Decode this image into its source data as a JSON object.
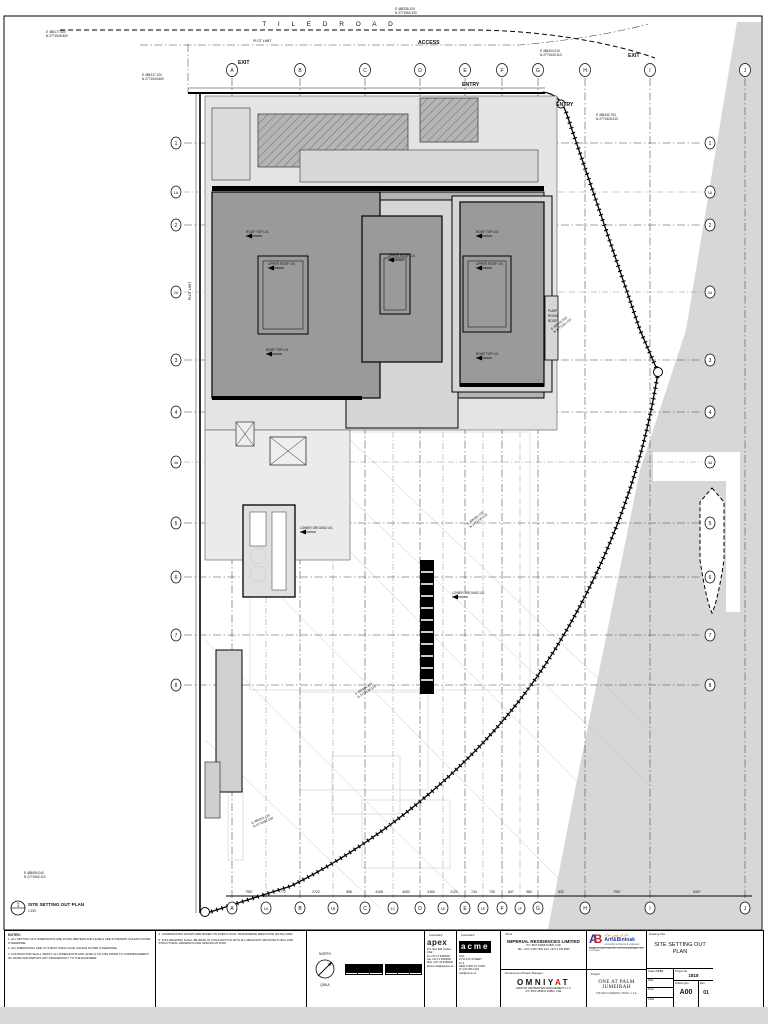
{
  "plan": {
    "road_label": "T I L E D    R O A D",
    "plot_limit": "PLOT LIMIT",
    "plot_limit_side": "PLOT LIMIT",
    "access": "ACCESS",
    "entry1": "ENTRY",
    "entry2": "ENTRY",
    "exit1": "EXIT",
    "exit2": "EXIT",
    "pump_room": [
      "PUMP",
      "ROOM",
      "ROOF"
    ],
    "cols_top": [
      "A",
      "B",
      "C",
      "D",
      "E",
      "F",
      "G",
      "H",
      "I",
      "J"
    ],
    "cols_bottom": [
      "A",
      "1A",
      "B",
      "1B",
      "C",
      "1C",
      "D",
      "1D",
      "E",
      "1E",
      "F",
      "1F",
      "G",
      "H",
      "I",
      "J"
    ],
    "rows": [
      "1",
      "1A",
      "2",
      "2A",
      "3",
      "4",
      "4A",
      "5",
      "6",
      "7",
      "8"
    ],
    "dims": [
      "7967",
      "772",
      "2722",
      "858",
      "4108",
      "4052",
      "3160",
      "2123",
      "744",
      "739",
      "847",
      "980",
      "832",
      "7967",
      "5407"
    ],
    "markers": [
      "ROOF TOP LVL",
      "UPPER ROOF LVL",
      "ROOF TOP LVL",
      "UPPER ROOF LVL",
      "ROOF TOP LVL",
      "UPPER ROOF LVL",
      "ROOF TOP LVL",
      "LOWER GROUND LVL",
      "LOWER GROUND LVL"
    ],
    "coords": [
      {
        "e": "E 485177.520",
        "n": "N 2771549.800"
      },
      {
        "e": "E 485217.120",
        "n": "N 2771543.600"
      },
      {
        "e": "E 485336.120",
        "n": "N 2771560.330"
      },
      {
        "e": "E 485402.010",
        "n": "N 2771549.110"
      },
      {
        "e": "E 485432.700",
        "n": "N 2771528.310"
      },
      {
        "e": "E 485411.010",
        "n": "N 2771352.210"
      },
      {
        "e": "E 485363.120",
        "n": "N 2771230.120"
      },
      {
        "e": "E 485286.220",
        "n": "N 2771138.110"
      },
      {
        "e": "E 485201.120",
        "n": "N 2771082.100"
      },
      {
        "e": "E 485080.040",
        "n": "N 2771062.110"
      }
    ],
    "view": {
      "num": "1",
      "title": "SITE SETTING OUT PLAN",
      "scale": "1:150"
    }
  },
  "titleblock": {
    "notes": {
      "heading": "NOTES:",
      "items": [
        "1.  ALL SETTING OUT DIMENSIONS ARE IN MILLIMETERS AND LEVELS ARE IN METERS UNLESS NOTED OTHERWISE.",
        "2.  ALL DIMENSIONS ARE TO STRUCTURAL FACE UNLESS NOTED OTHERWISE.",
        "3.  CONTRACTOR SHALL VERIFY ALL DIMENSIONS AND LEVELS ON SITE PRIOR TO COMMENCEMENT OF WORK AND REPORT ANY DISCREPANCY TO THE ENGINEER.",
        "4.  COORDINATES SHOWN ARE BASED ON DUBAI LOCAL TRANSVERSE MERCATOR (DLTM) GRID.",
        "5.  THIS DRAWING SHALL BE READ IN CONJUNCTION WITH ALL RELEVANT ARCHITECTURAL AND STRUCTURAL DRAWINGS AND SPECIFICATIONS."
      ]
    },
    "north": {
      "label": "NORTH",
      "qibla": "QIBLA"
    },
    "apex": {
      "label": "Consultant",
      "name": "apex",
      "lines": [
        "P.O. Box 966, Dubai, UAE",
        "Tel  +971 4 3366692",
        "Fax +971 4 3366693",
        "Mob +971 50 6466640",
        "Email  mail@apexco.ae"
      ]
    },
    "acme": {
      "label": "Consultant",
      "name": "acme",
      "lines": [
        "USA",
        "31 W 27th STREET",
        "FL 9",
        "NEW YORK NY 10001",
        "(T) 212 966 1203",
        "mail@acme.us"
      ]
    },
    "client": {
      "label": "Client",
      "name": "IMPERIAL RESIDENCES LIMITED",
      "line1": "P.O. BOX 52998   DUBAI,  UAE",
      "line2": "TEL: +971 4 330 7300    FAX: +971 4 330 9696"
    },
    "pm": {
      "label": "Development Project Manager",
      "name_pre": "OMNIY",
      "name_a": "A",
      "name_post": "T",
      "line1": "OMNIYAT PROPERTIES MANAGEMENT L.L.C",
      "line2": "P.O. BOX 283841  DUBAI, UAE"
    },
    "architect": {
      "arabic": "عارف وبن توك",
      "name": "Arif&Bintoak",
      "tagline": "consulting architects & engineers",
      "address": "DUBAI, P.O.BOX 1394  TEL: +971 4 2221146  FAX: +971 4 2224408"
    },
    "project": {
      "label": "Project",
      "name": "ONE AT PALM JUMEIRAH",
      "sub": "THE PALM JUMEIRAH, DUBAI, U.A.E."
    },
    "drawing": {
      "label": "Drawing Title",
      "name": "SITE SETTING OUT",
      "name2": "PLAN",
      "scale_label": "Scale",
      "scale": "1:150",
      "date_label": "Date",
      "drawn_label": "Drwn",
      "chkd_label": "Chkd",
      "projno_label": "Project No.",
      "projno": "1818",
      "dwgno_label": "Drawing No.",
      "dwgno": "A00",
      "rev_label": "Rev.",
      "rev": "01"
    }
  }
}
